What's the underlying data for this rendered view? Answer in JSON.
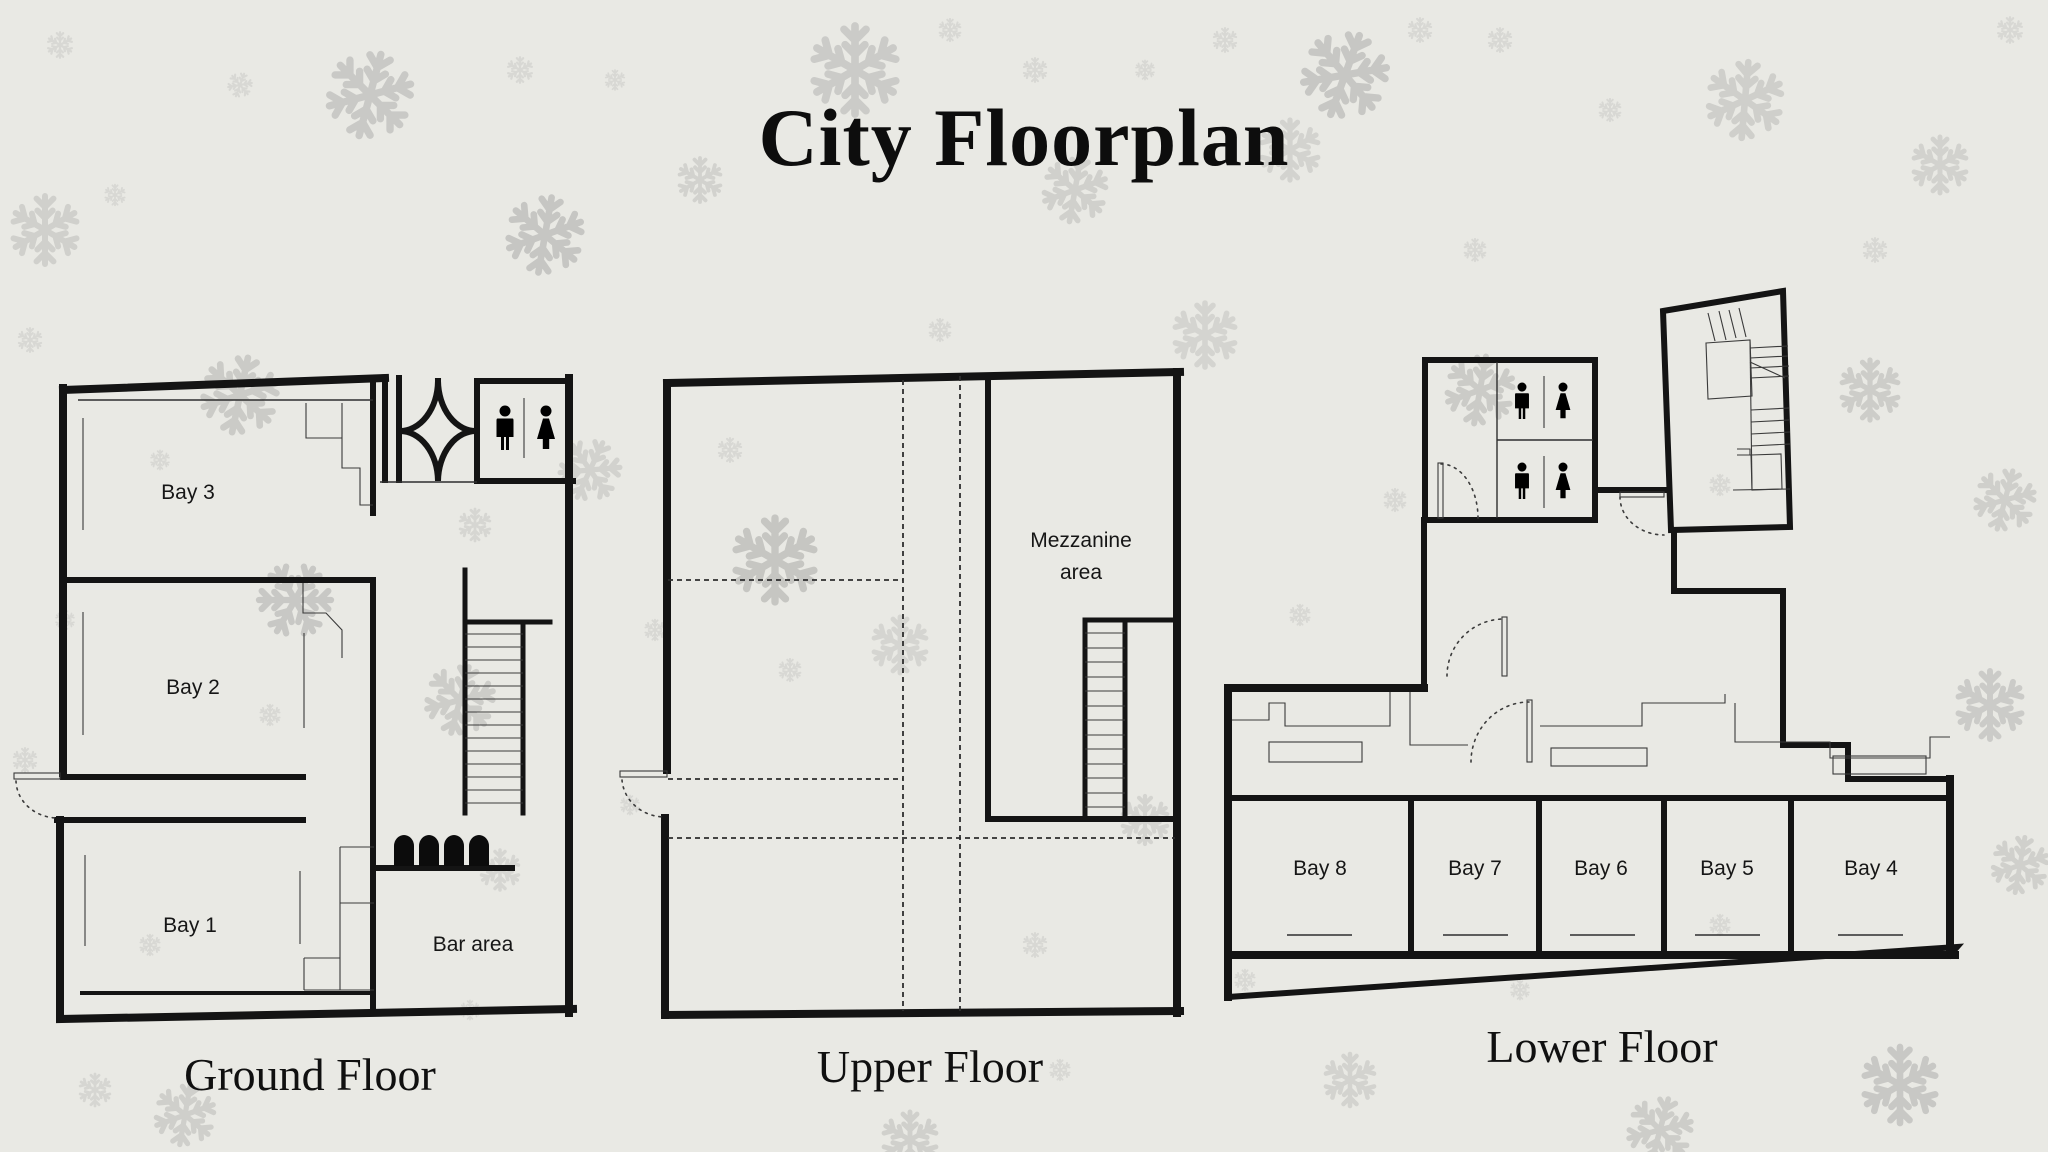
{
  "title": "City Floorplan",
  "floors": {
    "ground": {
      "name": "Ground Floor",
      "bay3": "Bay 3",
      "bay2": "Bay 2",
      "bay1": "Bay 1",
      "bar": "Bar area"
    },
    "upper": {
      "name": "Upper Floor",
      "mezzanine_line1": "Mezzanine",
      "mezzanine_line2": "area"
    },
    "lower": {
      "name": "Lower Floor",
      "bay8": "Bay 8",
      "bay7": "Bay 7",
      "bay6": "Bay 6",
      "bay5": "Bay 5",
      "bay4": "Bay 4"
    }
  },
  "icons": {
    "male": "male-restroom-icon",
    "female": "female-restroom-icon",
    "snowflake": "snowflake-icon",
    "stool": "bar-stool-icon",
    "stairs": "stairs-icon",
    "door": "door-swing-icon",
    "revolving_door": "revolving-door-icon"
  },
  "colors": {
    "background": "#e9e9e4",
    "wall": "#141414",
    "thin_line": "#2e2e2e",
    "text": "#101010",
    "snowflake_dark": "#c6c6c3",
    "snowflake_mid": "#cecece",
    "snowflake_light": "#d8d8d4"
  }
}
